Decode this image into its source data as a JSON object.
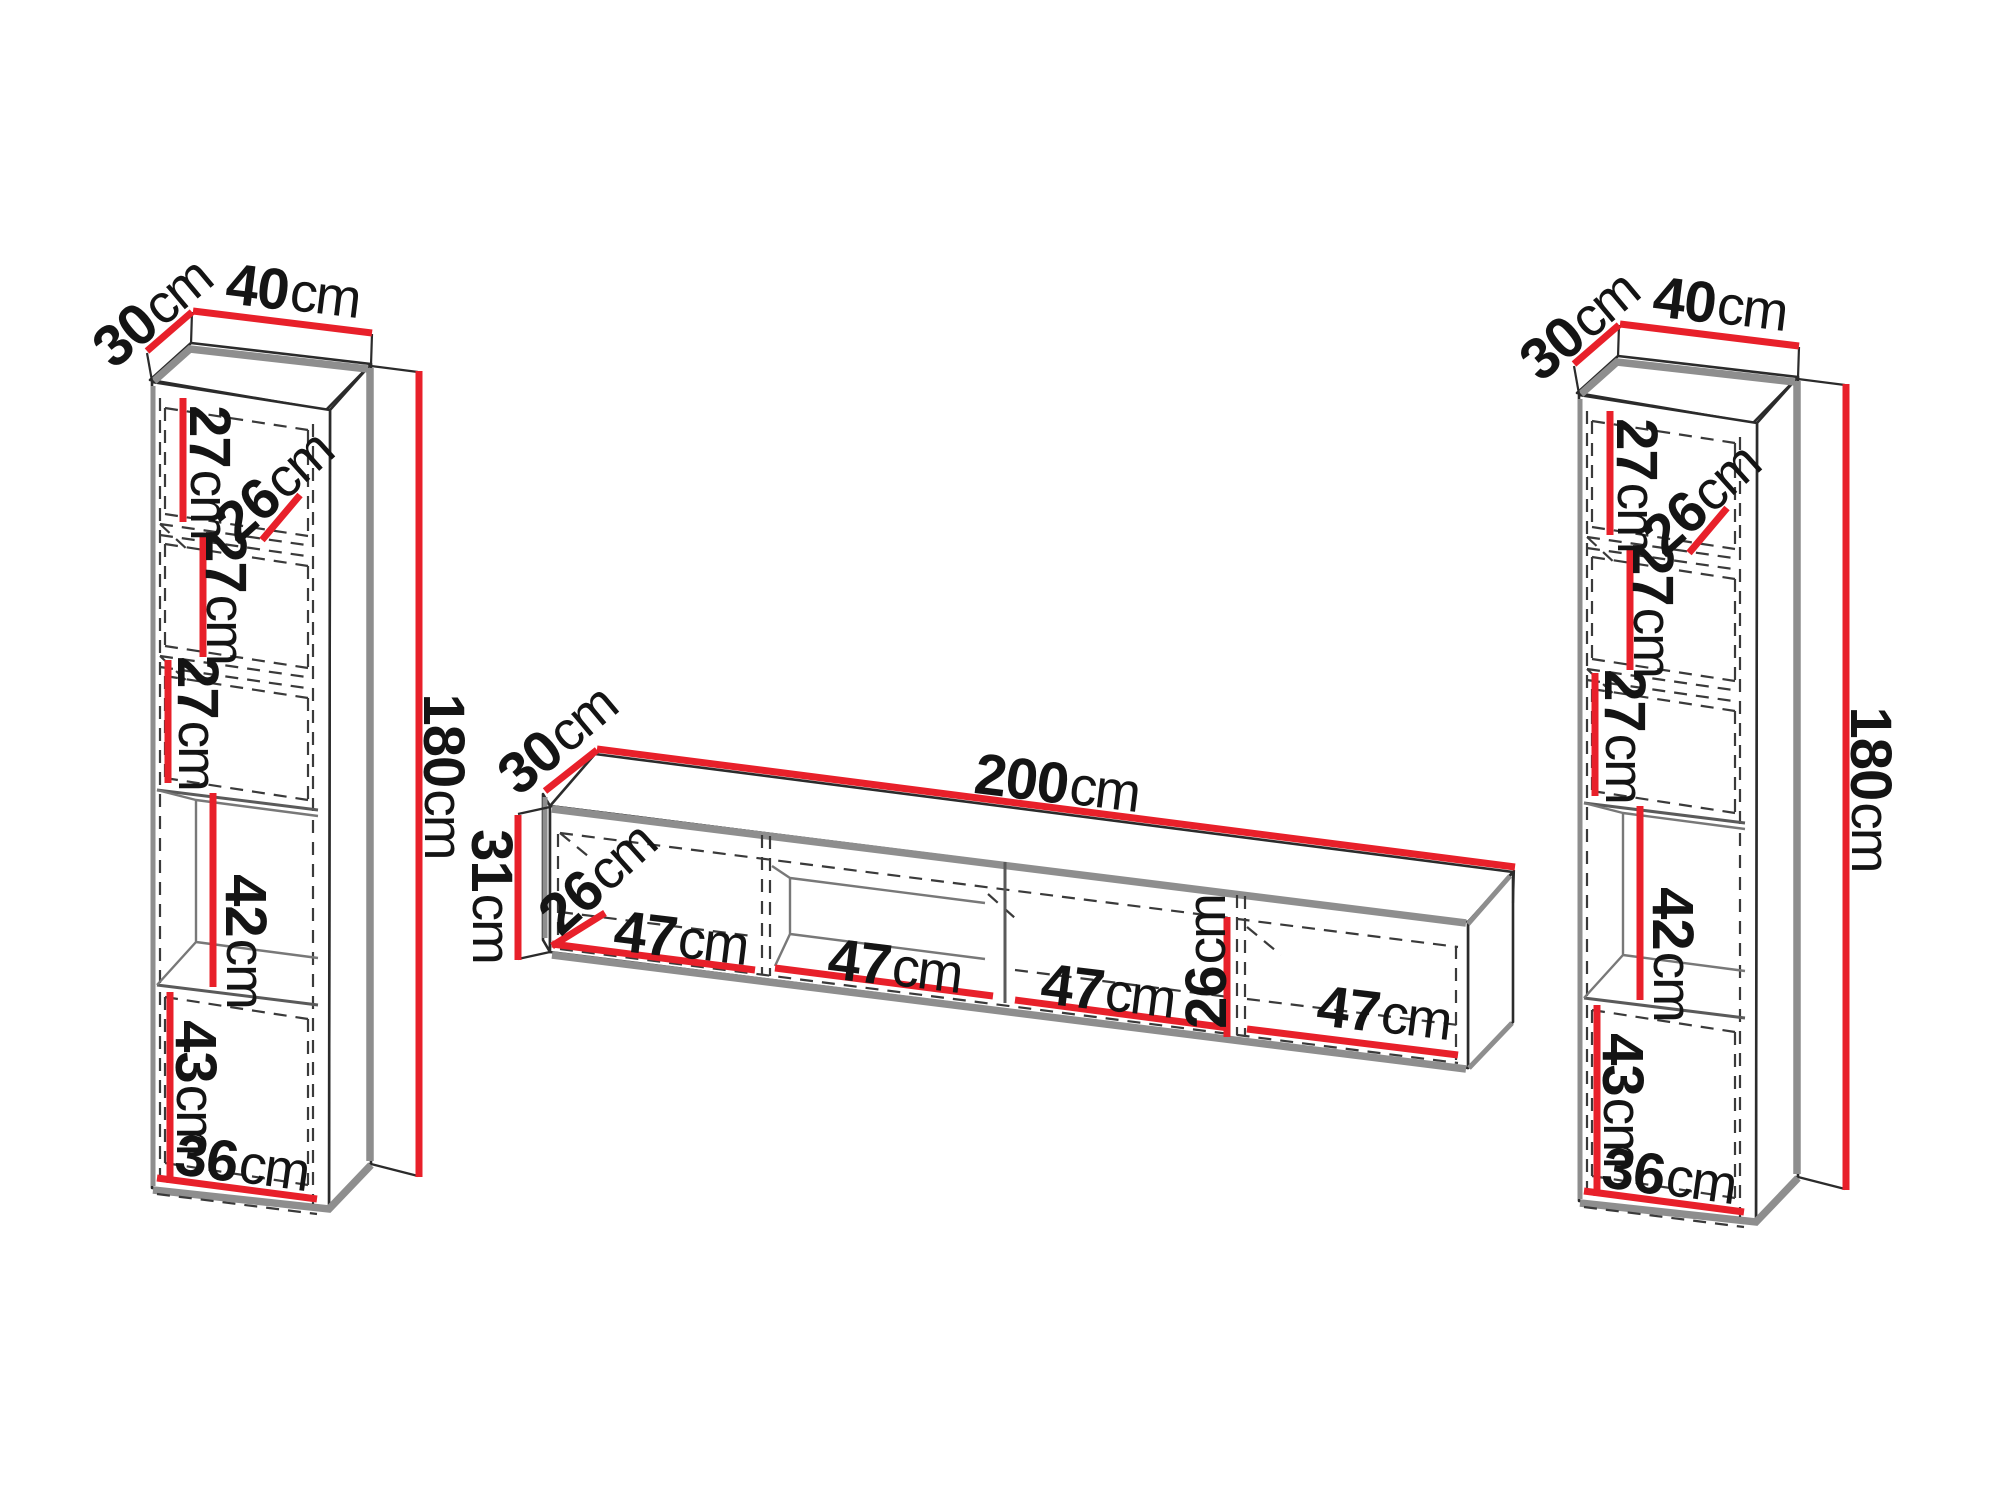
{
  "drawing": {
    "unit": "cm",
    "colors": {
      "dimension_red": "#e8202a",
      "edge_gray": "#8e8e8e",
      "outline_black": "#2b2b2b",
      "background": "#ffffff"
    },
    "left_cabinet": {
      "depth": "30",
      "width": "40",
      "height": "180",
      "shelf_1": "27",
      "interior_depth": "26",
      "shelf_2": "27",
      "shelf_3": "27",
      "open_shelf": "42",
      "shelf_5": "43",
      "interior_width": "36"
    },
    "tv_stand": {
      "depth": "30",
      "width": "200",
      "height": "31",
      "interior_depth": "26",
      "bay_1": "47",
      "bay_2": "47",
      "bay_3": "47",
      "interior_height": "26",
      "bay_4": "47"
    },
    "right_cabinet": {
      "depth": "30",
      "width": "40",
      "height": "180",
      "shelf_1": "27",
      "interior_depth": "26",
      "shelf_2": "27",
      "shelf_3": "27",
      "open_shelf": "42",
      "shelf_5": "43",
      "interior_width": "36"
    }
  }
}
